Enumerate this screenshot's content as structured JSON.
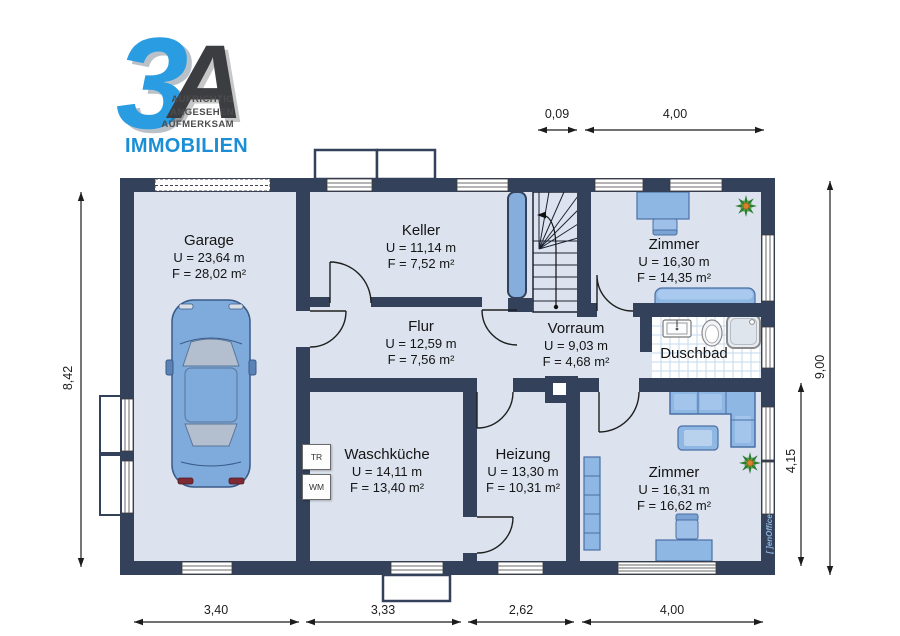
{
  "logo": {
    "mark_3": "3",
    "mark_a": "A",
    "tagline": [
      "AUFRICHTIG",
      "ANGESEHEN",
      "AUFMERKSAM"
    ],
    "brand": "IMMOBILIEN"
  },
  "rooms": [
    {
      "id": "garage",
      "name": "Garage",
      "u": "U = 23,64 m",
      "f": "F = 28,02 m²"
    },
    {
      "id": "keller",
      "name": "Keller",
      "u": "U = 11,14 m",
      "f": "F = 7,52 m²"
    },
    {
      "id": "flur",
      "name": "Flur",
      "u": "U = 12,59 m",
      "f": "F = 7,56 m²"
    },
    {
      "id": "vorraum",
      "name": "Vorraum",
      "u": "U = 9,03 m",
      "f": "F = 4,68 m²"
    },
    {
      "id": "zimmer-top",
      "name": "Zimmer",
      "u": "U = 16,30 m",
      "f": "F = 14,35 m²"
    },
    {
      "id": "duschbad",
      "name": "Duschbad"
    },
    {
      "id": "waschkueche",
      "name": "Waschküche",
      "u": "U = 14,11 m",
      "f": "F = 13,40 m²"
    },
    {
      "id": "heizung",
      "name": "Heizung",
      "u": "U = 13,30 m",
      "f": "F = 10,31 m²"
    },
    {
      "id": "zimmer-bottom",
      "name": "Zimmer",
      "u": "U = 16,31 m",
      "f": "F = 16,62 m²"
    }
  ],
  "appliances": {
    "dryer": "TR",
    "washer": "WM"
  },
  "dimensions": {
    "top": [
      "0,09",
      "4,00"
    ],
    "bottom": [
      "3,40",
      "3,33",
      "2,62",
      "4,00"
    ],
    "left": "8,42",
    "right_total": "9,00",
    "right_partial": "4,15"
  },
  "watermark": "[ ]enOffice",
  "colors": {
    "wall": "#33415b",
    "floor": "#dce3ee",
    "furniture": "#8fb7e3",
    "brand_blue": "#1b8ed6",
    "tile_line": "#c5daed"
  }
}
